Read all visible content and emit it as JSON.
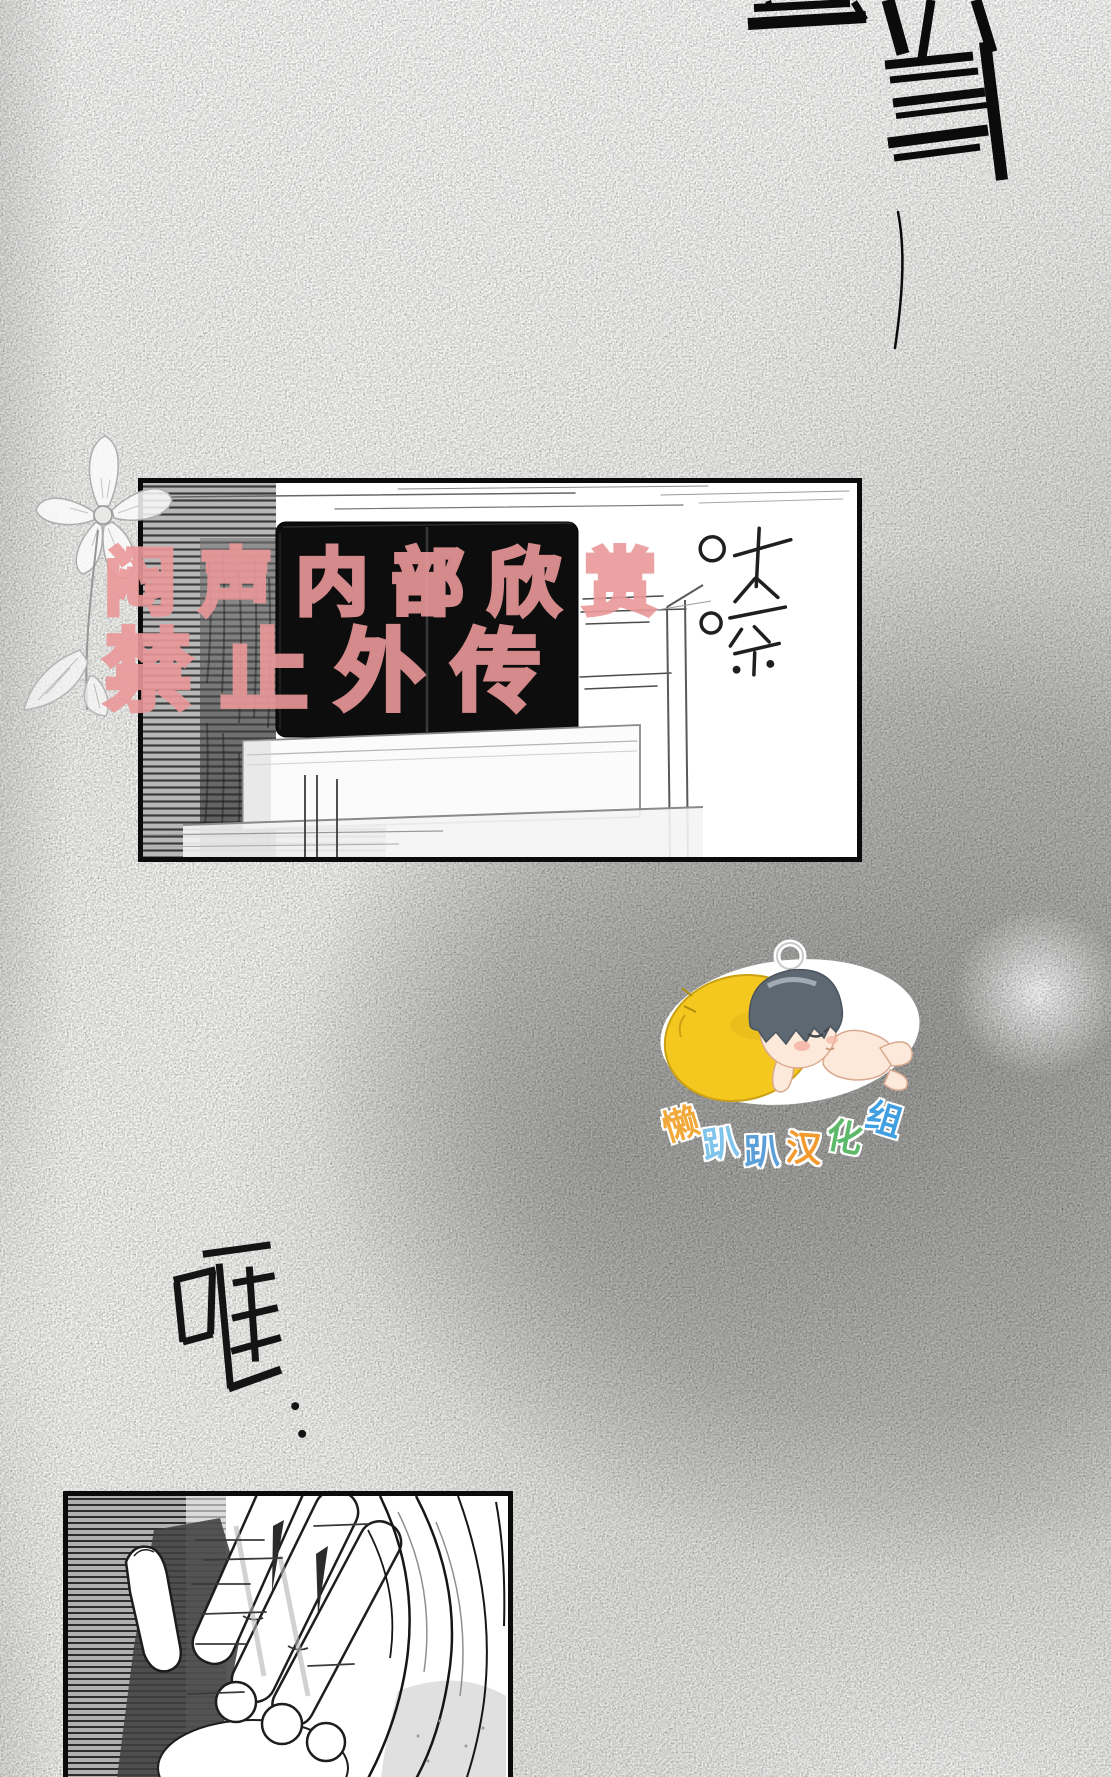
{
  "watermark": {
    "line1": "闷声内部欣赏",
    "line2": "禁止外传",
    "color": "#ea9898"
  },
  "sfx": {
    "top_right_brush": "当当",
    "shutter": "咔嚓",
    "clang": "哐",
    "clang_dots": "··"
  },
  "scanlation_logo": {
    "group_name": "懒趴趴汉化组",
    "chars": [
      {
        "char": "懒",
        "color": "#f2a93b"
      },
      {
        "char": "趴",
        "color": "#7fc4ea"
      },
      {
        "char": "趴",
        "color": "#5b9fd8"
      },
      {
        "char": "汉",
        "color": "#f29a2e"
      },
      {
        "char": "化",
        "color": "#5cb96a"
      },
      {
        "char": "组",
        "color": "#3f9fe0"
      }
    ],
    "pillow_color": "#f4c81f",
    "hair_color": "#5d6873",
    "sticker_outline": "#ffffff"
  },
  "panels": {
    "top": {
      "description": "Dark twin television screens on a white media cabinet beside a doorway, venetian-blind hatching on the left"
    },
    "bottom": {
      "description": "Close-up of a hand reaching through long flowing hair"
    }
  },
  "decorations": {
    "flower": "hand-sketched flower with long stem and leaves"
  }
}
